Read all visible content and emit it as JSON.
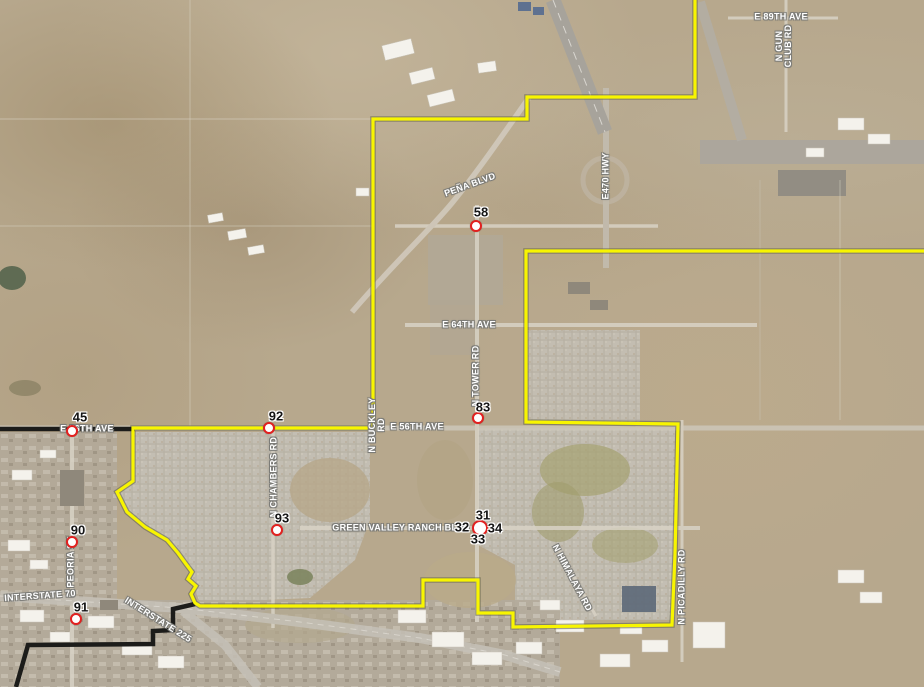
{
  "map": {
    "description": "Aerial satellite map with municipal boundary overlay and numbered site markers",
    "boundary": {
      "primary_color": "#f8f500",
      "secondary_color": "#1c1c1a"
    },
    "marker_style": {
      "ring_color": "#e2201f",
      "fill_color": "#ffffff",
      "label_color": "#151515"
    }
  },
  "road_labels": [
    {
      "name": "e-89th-ave",
      "text": "E 89TH AVE",
      "x": 781,
      "y": 17,
      "rot": 0
    },
    {
      "name": "n-gun-club-rd",
      "lines": [
        "N GUN",
        "CLUB RD"
      ],
      "x": 784,
      "y": 46,
      "rot": -90
    },
    {
      "name": "pena-blvd",
      "text": "PEÑA BLVD",
      "x": 470,
      "y": 185,
      "rot": -20
    },
    {
      "name": "e-470-hwy",
      "text": "E470 HWY",
      "x": 606,
      "y": 176,
      "rot": -90
    },
    {
      "name": "e-64th-ave",
      "text": "E 64TH AVE",
      "x": 469,
      "y": 325,
      "rot": 0
    },
    {
      "name": "n-tower-rd",
      "text": "N TOWER RD",
      "x": 476,
      "y": 376,
      "rot": -90
    },
    {
      "name": "e-56th-ave-west",
      "text": "E 56TH AVE",
      "x": 87,
      "y": 429,
      "rot": 0
    },
    {
      "name": "n-buckley-rd",
      "lines": [
        "N BUCKLEY",
        "RD"
      ],
      "x": 377,
      "y": 425,
      "rot": -90
    },
    {
      "name": "e-56th-ave-mid",
      "text": "E 56TH AVE",
      "x": 417,
      "y": 427,
      "rot": 0
    },
    {
      "name": "green-valley-ranch-blvd",
      "text": "GREEN VALLEY RANCH BLVD",
      "x": 401,
      "y": 528,
      "rot": 0
    },
    {
      "name": "n-chambers-rd",
      "text": "N CHAMBERS RD",
      "x": 274,
      "y": 477,
      "rot": -90
    },
    {
      "name": "n-peoria-st",
      "text": "N PEORIA ST",
      "x": 71,
      "y": 567,
      "rot": -90
    },
    {
      "name": "n-himalaya-rd",
      "text": "N HIMALAYA RD",
      "x": 572,
      "y": 578,
      "rot": 62
    },
    {
      "name": "n-picadilly-rd",
      "text": "N PICADILLY RD",
      "x": 682,
      "y": 587,
      "rot": -90
    },
    {
      "name": "interstate-70",
      "text": "INTERSTATE 70",
      "x": 40,
      "y": 596,
      "rot": -4
    },
    {
      "name": "interstate-225",
      "text": "INTERSTATE 225",
      "x": 158,
      "y": 620,
      "rot": 32
    }
  ],
  "markers": [
    {
      "id": "45",
      "label_x": 80,
      "label_y": 417,
      "cx": 72,
      "cy": 431,
      "r": 6
    },
    {
      "id": "92",
      "label_x": 276,
      "label_y": 416,
      "cx": 269,
      "cy": 428,
      "r": 6
    },
    {
      "id": "58",
      "label_x": 481,
      "label_y": 212,
      "cx": 476,
      "cy": 226,
      "r": 6
    },
    {
      "id": "83",
      "label_x": 483,
      "label_y": 407,
      "cx": 478,
      "cy": 418,
      "r": 6
    },
    {
      "id": "93",
      "label_x": 282,
      "label_y": 518,
      "cx": 277,
      "cy": 530,
      "r": 6
    },
    {
      "id": "90",
      "label_x": 78,
      "label_y": 530,
      "cx": 72,
      "cy": 542,
      "r": 6
    },
    {
      "id": "91",
      "label_x": 81,
      "label_y": 607,
      "cx": 76,
      "cy": 619,
      "r": 6
    },
    {
      "id": "31",
      "label_x": 483,
      "label_y": 515,
      "cx": 480,
      "cy": 528,
      "r": 8
    },
    {
      "id": "32",
      "label_x": 462,
      "label_y": 527,
      "cx": 0,
      "cy": 0,
      "r": 0
    },
    {
      "id": "34",
      "label_x": 495,
      "label_y": 528,
      "cx": 0,
      "cy": 0,
      "r": 0
    },
    {
      "id": "33",
      "label_x": 478,
      "label_y": 539,
      "cx": 0,
      "cy": 0,
      "r": 0
    }
  ]
}
